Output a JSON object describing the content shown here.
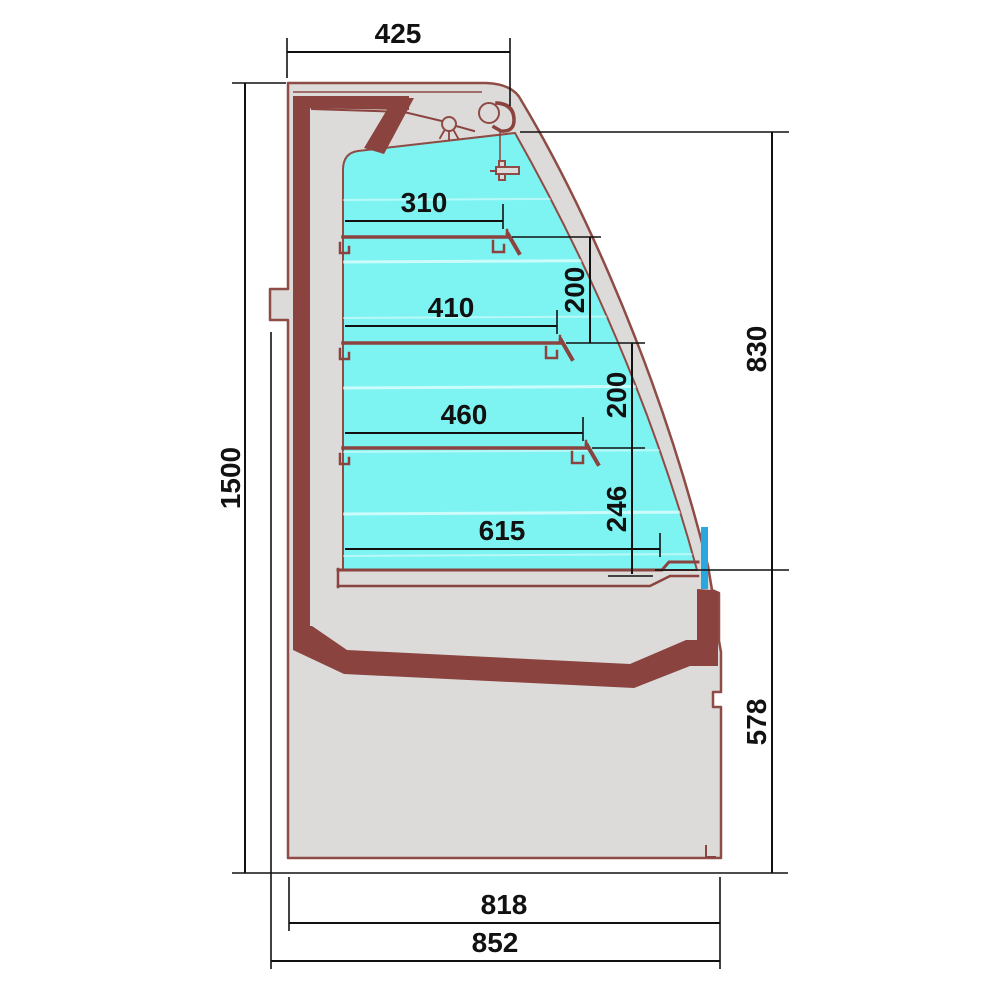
{
  "drawing": {
    "type": "technical-cross-section",
    "subject": "refrigerated display case side profile with shelf dimensions",
    "dimensions": {
      "canopy_depth": "425",
      "overall_height": "1500",
      "shelf_depth_1": "310",
      "shelf_depth_2": "410",
      "shelf_depth_3": "460",
      "well_depth": "615",
      "shelf_spacing_1": "200",
      "shelf_spacing_2": "200",
      "bottom_clearance": "246",
      "opening_height": "830",
      "base_height": "578",
      "base_depth": "818",
      "overall_depth": "852"
    },
    "colors": {
      "display_area": "#7EF4F2",
      "insulation": "#8B4340",
      "outline": "#8F4B45",
      "panel_gray": "#DCDBD9",
      "glass_seal_blue": "#2AA7DF",
      "dimension_lines": "#111111",
      "background": "#FFFFFF"
    }
  }
}
